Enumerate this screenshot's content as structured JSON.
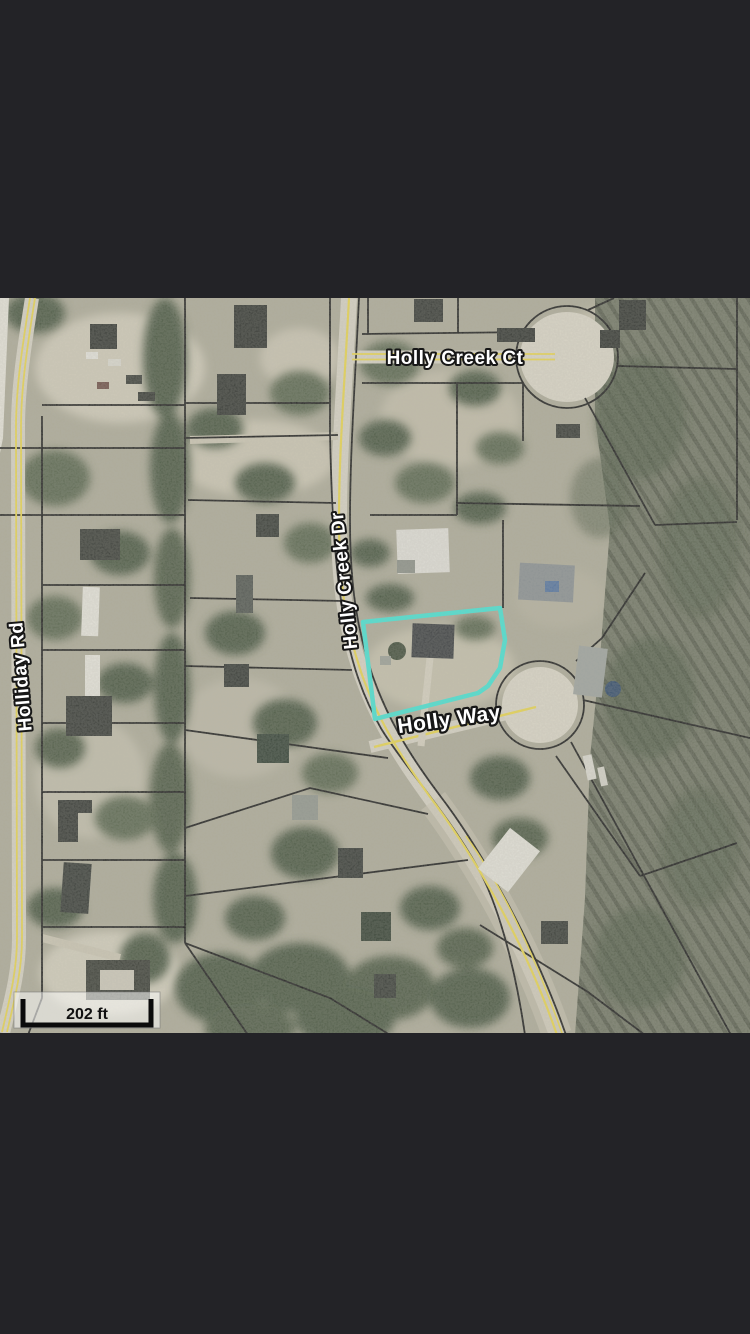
{
  "app": {
    "description": "Mobile screenshot of an aerial GIS parcel map with a highlighted lot",
    "letterbox_color": "#232327"
  },
  "map": {
    "labels": {
      "holly_creek_ct": "Holly Creek Ct",
      "holly_creek_dr": "Holly Creek Dr",
      "holliday_rd": "Holliday Rd",
      "holly_way": "Holly Way"
    },
    "scale_bar": {
      "label": "202 ft"
    },
    "selected_parcel": {
      "outline_color": "#3FE6D6"
    },
    "colors": {
      "road_centerline": "#EED94A",
      "parcel_boundary": "#141414",
      "pavement": "#D9D4C6",
      "woodland": "#4A5741",
      "clearing": "#D2CCBA"
    }
  }
}
